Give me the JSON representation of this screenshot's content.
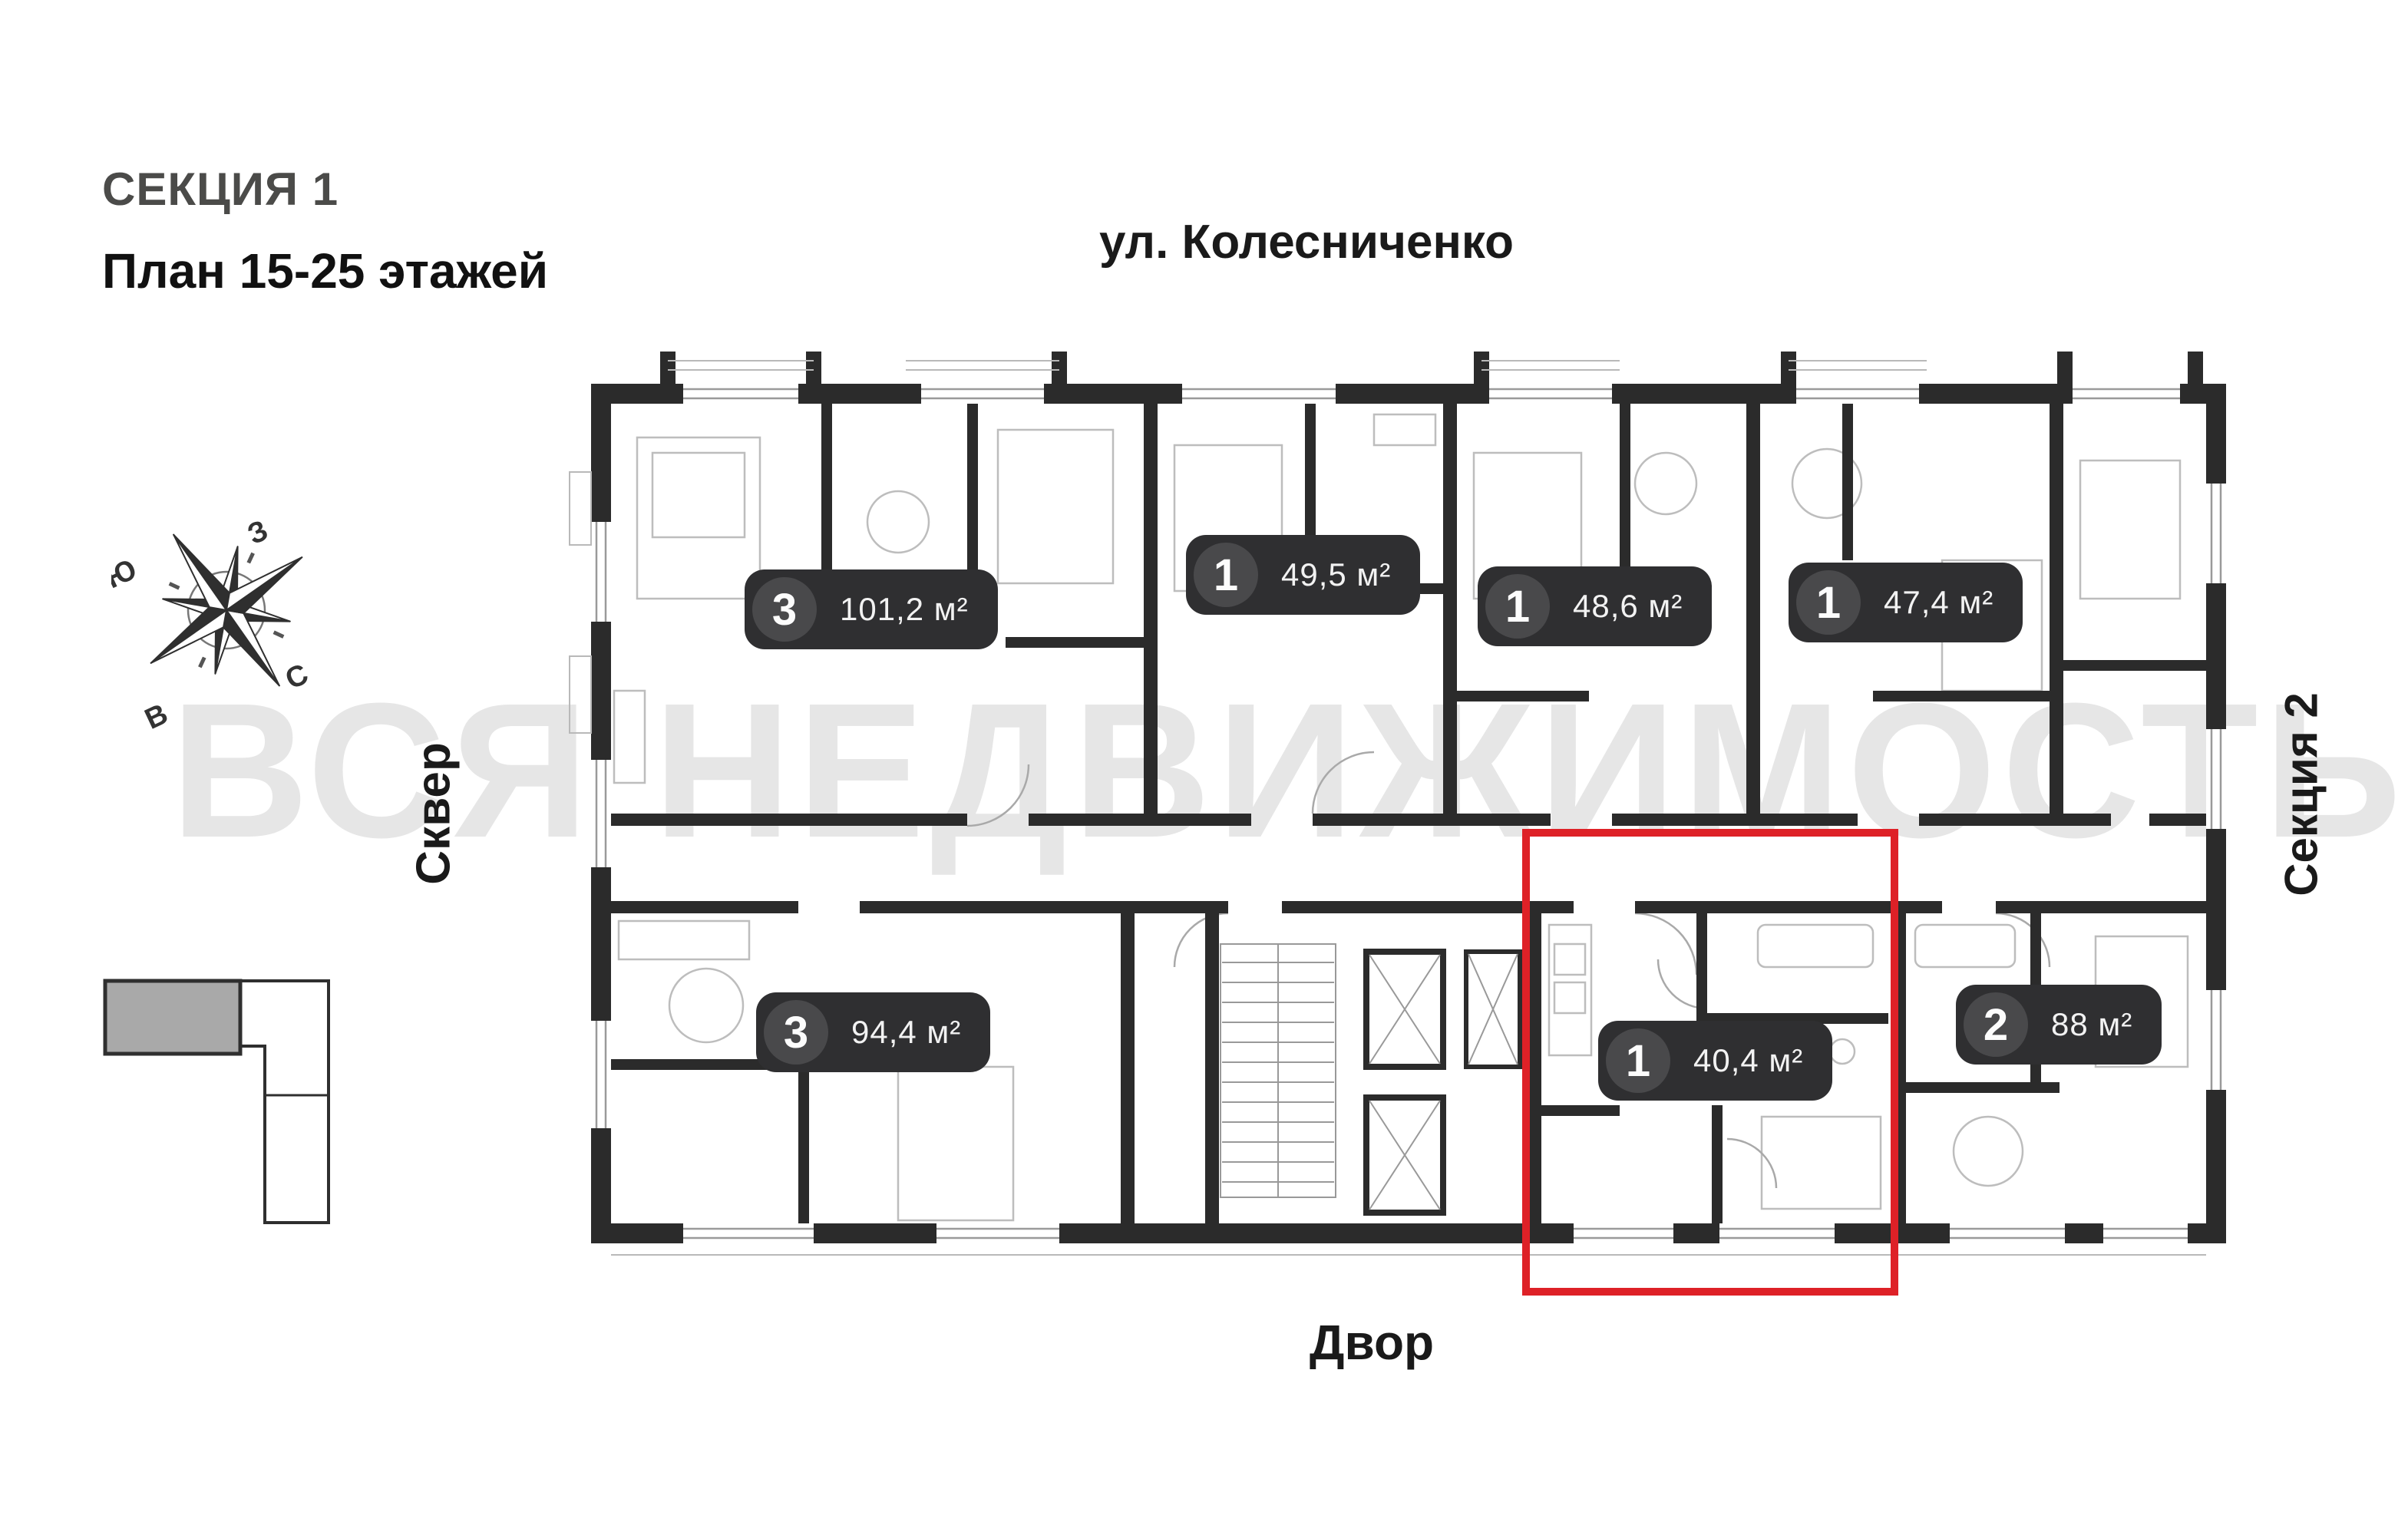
{
  "header": {
    "section_title": "СЕКЦИЯ 1",
    "plan_range": "План 15-25 этажей"
  },
  "surroundings": {
    "street": "ул. Колесниченко",
    "left_area": "Сквер",
    "right_area": "Секция 2",
    "bottom_area": "Двор"
  },
  "compass": {
    "south": "Ю",
    "west": "З",
    "north": "С",
    "east": "В"
  },
  "watermark": {
    "text": "ВСЯ НЕДВИЖИМОСТЬ",
    "color": "#e6e6e6"
  },
  "apartments": [
    {
      "rooms": "3",
      "area": "101,2 м²",
      "highlighted": false
    },
    {
      "rooms": "1",
      "area": "49,5 м²",
      "highlighted": false
    },
    {
      "rooms": "1",
      "area": "48,6 м²",
      "highlighted": false
    },
    {
      "rooms": "1",
      "area": "47,4 м²",
      "highlighted": false
    },
    {
      "rooms": "3",
      "area": "94,4 м²",
      "highlighted": false
    },
    {
      "rooms": "1",
      "area": "40,4 м²",
      "highlighted": true
    },
    {
      "rooms": "2",
      "area": "88 м²",
      "highlighted": false
    }
  ],
  "colors": {
    "wall": "#2b2b2b",
    "badge_bg": "#2f2f31",
    "badge_circle": "#49494b",
    "highlight": "#de2127",
    "watermark": "#e6e6e6"
  }
}
